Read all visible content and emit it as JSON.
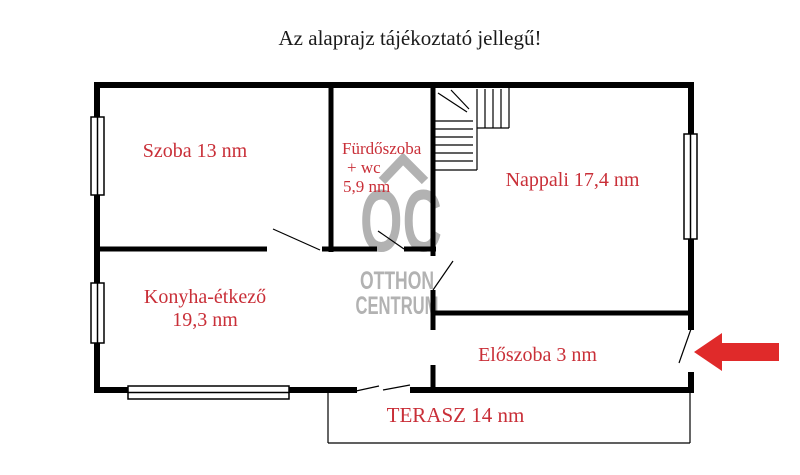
{
  "title": "Az alaprajz tájékoztató jellegű!",
  "watermark": {
    "logo": "OC",
    "name_line1": "OTTHON",
    "name_line2": "CENTRUM"
  },
  "rooms": {
    "szoba": {
      "label": "Szoba 13 nm"
    },
    "furdoszoba": {
      "line1": "Fürdőszoba",
      "line2": "+ wc",
      "line3": "5,9 nm"
    },
    "nappali": {
      "label": "Nappali 17,4 nm"
    },
    "konyha": {
      "line1": "Konyha-étkező",
      "line2": "19,3 nm"
    },
    "eloszoba": {
      "label": "Előszoba 3 nm"
    },
    "terasz": {
      "label": "TERASZ 14 nm"
    }
  },
  "colors": {
    "label_red": "#c92f38",
    "arrow_red": "#e02a2a",
    "watermark_gray": "#b2b2b2",
    "wall_black": "#000000"
  }
}
